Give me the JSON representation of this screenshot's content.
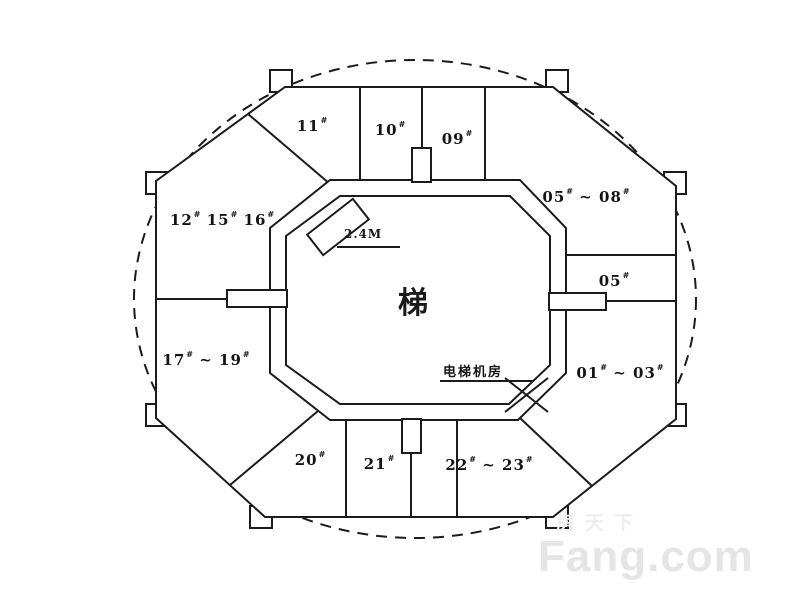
{
  "plan": {
    "core_label": "梯",
    "units": {
      "u11": [
        [
          "11",
          false
        ],
        [
          "#",
          true
        ]
      ],
      "u10": [
        [
          "10",
          false
        ],
        [
          "#",
          true
        ]
      ],
      "u09": [
        [
          "09",
          false
        ],
        [
          "#",
          true
        ]
      ],
      "u05_08": [
        [
          "05",
          false
        ],
        [
          "#",
          true
        ],
        [
          " ~ 08",
          false
        ],
        [
          "#",
          true
        ]
      ],
      "u05": [
        [
          "05",
          false
        ],
        [
          "#",
          true
        ]
      ],
      "u01_03": [
        [
          "01",
          false
        ],
        [
          "#",
          true
        ],
        [
          " ~ 03",
          false
        ],
        [
          "#",
          true
        ]
      ],
      "u12_15_16": [
        [
          "12",
          false
        ],
        [
          "#",
          true
        ],
        [
          " 15",
          false
        ],
        [
          "#",
          true
        ],
        [
          " 16",
          false
        ],
        [
          "#",
          true
        ]
      ],
      "u17_19": [
        [
          "17",
          false
        ],
        [
          "#",
          true
        ],
        [
          " ~ 19",
          false
        ],
        [
          "#",
          true
        ]
      ],
      "u20": [
        [
          "20",
          false
        ],
        [
          "#",
          true
        ]
      ],
      "u21": [
        [
          "21",
          false
        ],
        [
          "#",
          true
        ]
      ],
      "u22_23": [
        [
          "22",
          false
        ],
        [
          "#",
          true
        ],
        [
          " ~ 23",
          false
        ],
        [
          "#",
          true
        ]
      ]
    },
    "annotations": {
      "ramp_dimension": "2.4M",
      "elevator_room": "电梯机房"
    }
  },
  "watermark": {
    "cn": "房天下",
    "en": "Fang.com"
  },
  "colors": {
    "wall_line": "#1b1b1b",
    "watermark_text": "#e5e5e5",
    "background": "#ffffff"
  }
}
